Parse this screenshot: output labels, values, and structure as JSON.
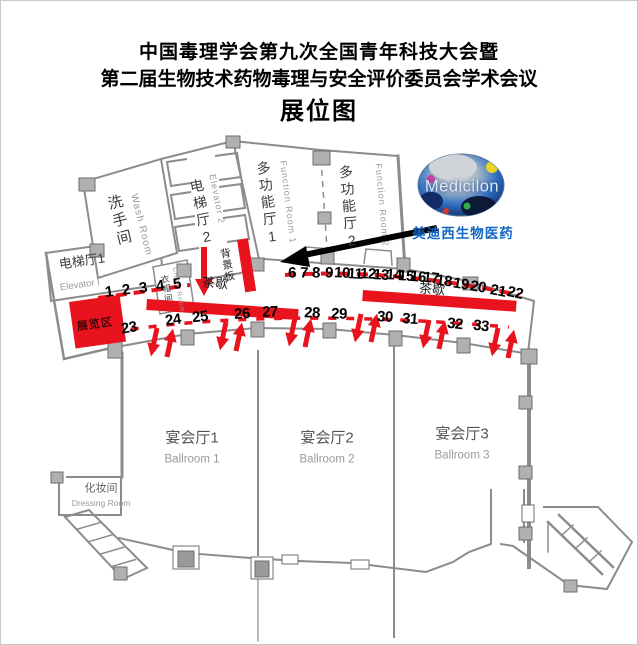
{
  "title": {
    "line1": "中国毒理学会第九次全国青年科技大会暨",
    "line2": "第二届生物技术药物毒理与安全评价委员会学术会议",
    "line3": "展位图"
  },
  "rooms": {
    "wash": {
      "cn": "洗手间",
      "en": "Wash Room"
    },
    "elevator2": {
      "cn": "电梯厅2",
      "en": "Elevator 2"
    },
    "cloak": {
      "cn": "衣帽间",
      "en": "Cloak Room"
    },
    "function1": {
      "cn": "多功能厅1",
      "en": "Function Room 1"
    },
    "function2": {
      "cn": "多功能厅2",
      "en": "Function Room 2"
    },
    "elevator1": {
      "cn": "电梯厅1",
      "en": "Elevator I"
    },
    "ballroom1": {
      "cn": "宴会厅1",
      "en": "Ballroom 1"
    },
    "ballroom2": {
      "cn": "宴会厅2",
      "en": "Ballroom 2"
    },
    "ballroom3": {
      "cn": "宴会厅3",
      "en": "Ballroom 3"
    },
    "dressing": {
      "cn": "化妆间",
      "en": "Dressing Room"
    }
  },
  "labels": {
    "backdrop": "背景板",
    "exhibition_zone": "展览区",
    "tea_break_left": "茶歇",
    "tea_break_right": "茶歇"
  },
  "logo": {
    "name": "Medicilon",
    "cn": "美迪西生物医药"
  },
  "booths": {
    "top": [
      "1",
      "2",
      "3",
      "4",
      "5",
      "6",
      "7",
      "8",
      "9",
      "10",
      "11",
      "12",
      "13",
      "14",
      "15",
      "16",
      "17",
      "18",
      "19",
      "20",
      "21",
      "22"
    ],
    "bottom": [
      "23",
      "24",
      "25",
      "26",
      "27",
      "28",
      "29",
      "30",
      "31",
      "32",
      "33"
    ]
  },
  "colors": {
    "red": "#e8131d",
    "blue": "#1166c4",
    "wall": "#8c8c8c"
  }
}
